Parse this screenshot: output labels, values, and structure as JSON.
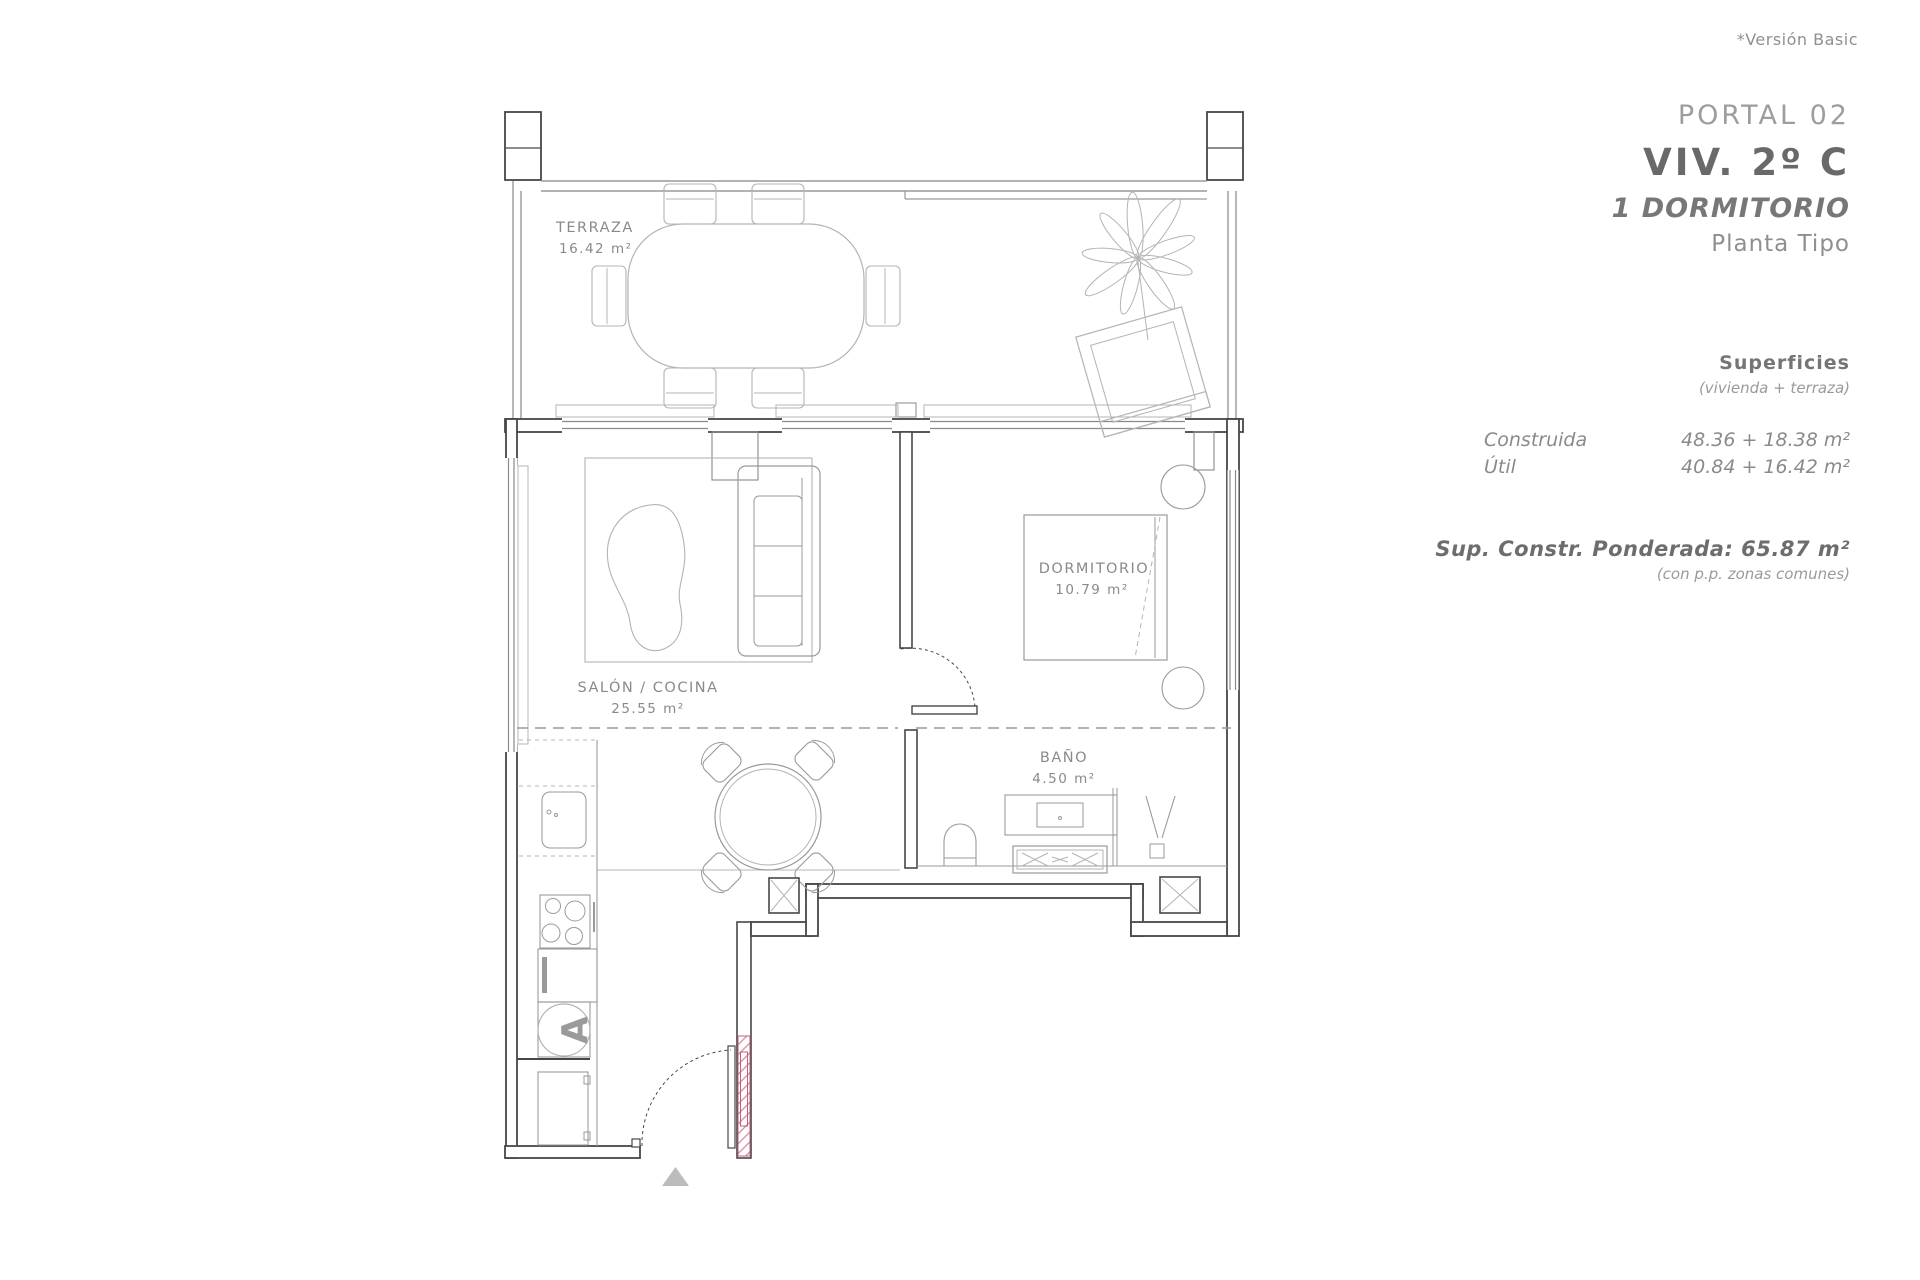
{
  "header": {
    "version_note": "*Versión Basic"
  },
  "title_block": {
    "portal": "PORTAL 02",
    "unit": "VIV. 2º C",
    "type": "1 DORMITORIO",
    "floor": "Planta Tipo"
  },
  "surfaces": {
    "heading": "Superficies",
    "subheading": "(vivienda + terraza)",
    "rows": [
      {
        "label": "Construida",
        "value": "48.36 + 18.38 m²"
      },
      {
        "label": "Útil",
        "value": "40.84 + 16.42 m²"
      }
    ],
    "weighted_label": "Sup. Constr. Ponderada: 65.87 m²",
    "weighted_note": "(con p.p. zonas comunes)"
  },
  "plan": {
    "rooms": [
      {
        "name": "TERRAZA",
        "area": "16.42 m²"
      },
      {
        "name": "SALÓN / COCINA",
        "area": "25.55 m²"
      },
      {
        "name": "DORMITORIO",
        "area": "10.79 m²"
      },
      {
        "name": "BAÑO",
        "area": "4.50 m²"
      }
    ],
    "appliance_label": "A"
  },
  "colors": {
    "wall": "#474747",
    "window": "#8a8a8a",
    "furniture": "#b4b4b4",
    "text": "#8a8a8a",
    "title_dark": "#696969",
    "hatch_pink": "#d98ba2",
    "hatch_edge": "#c2607b",
    "arrow_gray": "#bcbcbc"
  }
}
